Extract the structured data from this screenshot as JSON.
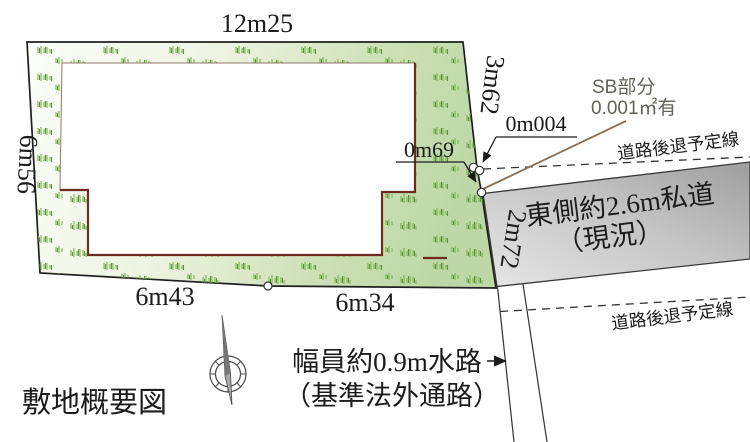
{
  "diagram": {
    "title": "敷地概要図",
    "dimensions": {
      "top": "12m25",
      "left": "6m56",
      "right_upper": "3m62",
      "sliver": "0m004",
      "right_mid": "0m69",
      "right_lower": "2m72",
      "bottom_left": "6m43",
      "bottom_right": "6m34"
    },
    "annotations": {
      "sb_line1": "SB部分",
      "sb_line2": "0.001㎡有",
      "setback_upper": "道路後退予定線",
      "setback_lower": "道路後退予定線",
      "waterway_line1": "幅員約0.9m水路",
      "waterway_line2": "（基準法外通路）"
    },
    "road": {
      "name": "東側約2.6m私道",
      "status": "（現況）"
    },
    "colors": {
      "plot_green": "#c7ddb0",
      "plot_green_pale": "#f7faf1",
      "grass_green": "#7cb14e",
      "grass_green_dark": "#569a36",
      "building_outline_maroon": "#6d2c1f",
      "building_outline_thin": "#93796a",
      "road_gray_dark": "#a5a5a5",
      "road_gray_light": "#e2e2e2",
      "leader_brown": "#8a6f4b",
      "line_black": "#222222"
    }
  }
}
